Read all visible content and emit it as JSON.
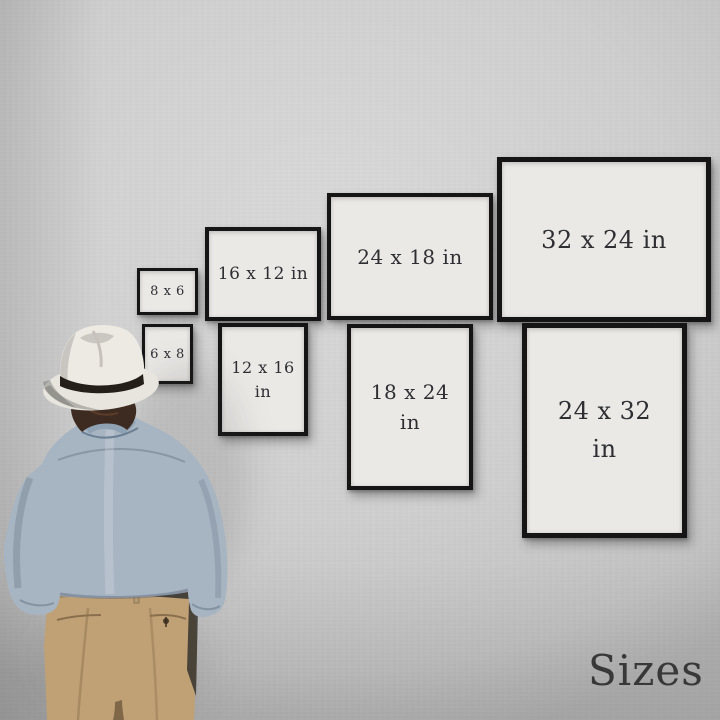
{
  "page": {
    "corner_label": "Sizes"
  },
  "colors": {
    "wall": "#cfcfcf",
    "frame_border": "#151515",
    "frame_mat": "#ebe9e6",
    "label_text": "#2f2f33",
    "hat": "#e8e5df",
    "hat_band": "#242019",
    "hair": "#3d2b21",
    "shirt": "#a7b4c2",
    "pants": "#c0a176"
  },
  "frames": [
    {
      "name": "frame-8x6",
      "orientation": "landscape",
      "line1": "8 x 6",
      "line2": ""
    },
    {
      "name": "frame-16x12",
      "orientation": "landscape",
      "line1": "16 x 12 in",
      "line2": ""
    },
    {
      "name": "frame-24x18",
      "orientation": "landscape",
      "line1": "24 x 18 in",
      "line2": ""
    },
    {
      "name": "frame-32x24",
      "orientation": "landscape",
      "line1": "32 x 24 in",
      "line2": ""
    },
    {
      "name": "frame-6x8",
      "orientation": "portrait",
      "line1": "6 x 8",
      "line2": ""
    },
    {
      "name": "frame-12x16",
      "orientation": "portrait",
      "line1": "12 x 16",
      "line2": "in"
    },
    {
      "name": "frame-18x24",
      "orientation": "portrait",
      "line1": "18 x 24",
      "line2": "in"
    },
    {
      "name": "frame-24x32",
      "orientation": "portrait",
      "line1": "24 x 32",
      "line2": "in"
    }
  ],
  "figure": {
    "name": "man-viewing-wall"
  }
}
